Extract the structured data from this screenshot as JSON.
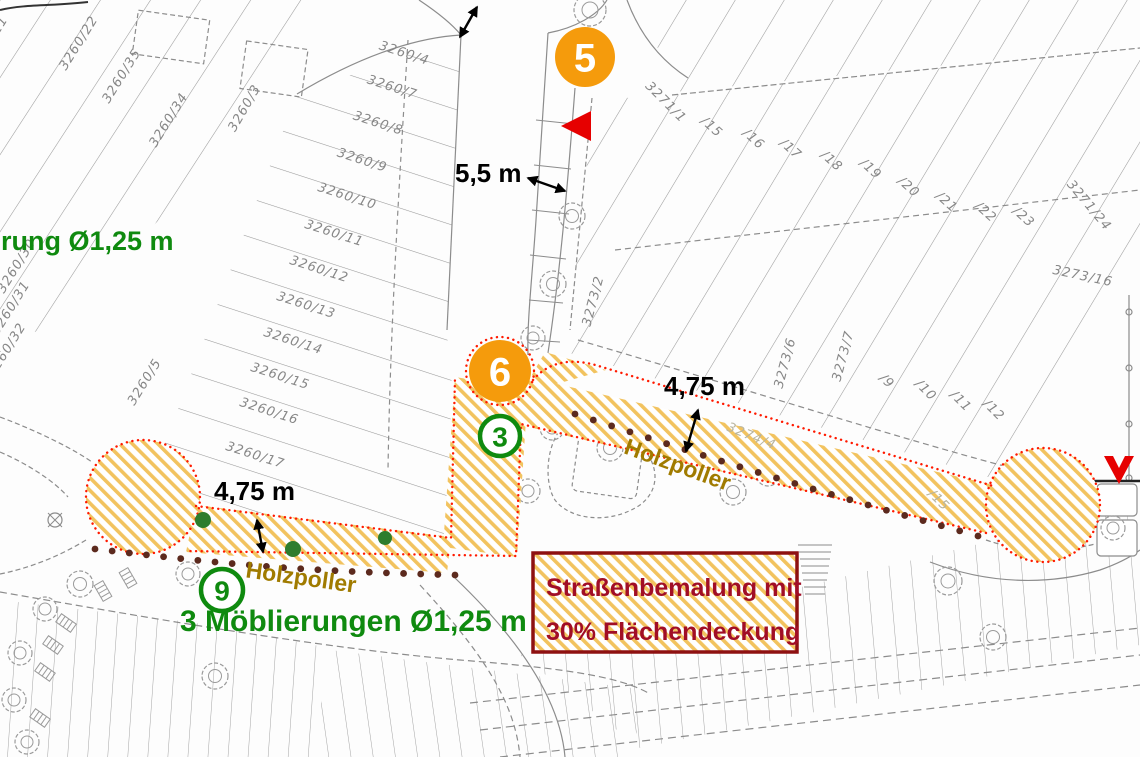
{
  "title": "Straßenbemalung Lageplan",
  "colors": {
    "paint_hatch": "#F2C35F",
    "paint_outline": "#FF1A00",
    "marker_orange": "#F59B0C",
    "marker_green": "#0F8A0F",
    "bollard_brown": "#5C2A1E",
    "furnishing_green": "#2E7D2E",
    "legend_border": "#8E1111",
    "legend_text": "#A10E26",
    "holzpoller_text": "#A07B00",
    "linework_gray": "#8C8C8C"
  },
  "legend": {
    "line1": "Straßenbemalung mit",
    "line2": "30% Flächendeckung"
  },
  "markers": {
    "orange": [
      {
        "label": "5",
        "x": 585,
        "y": 57
      },
      {
        "label": "6",
        "x": 500,
        "y": 371
      }
    ],
    "green": [
      {
        "label": "3",
        "x": 500,
        "y": 436
      },
      {
        "label": "9",
        "x": 222,
        "y": 590
      }
    ]
  },
  "measurements": [
    {
      "text": "5,5 m",
      "x": 455,
      "y": 182
    },
    {
      "text": "4,75 m",
      "x": 214,
      "y": 500
    },
    {
      "text": "4,75 m",
      "x": 664,
      "y": 395
    }
  ],
  "holzpoller_labels": [
    {
      "text": "Holzpoller",
      "x": 675,
      "y": 472,
      "rot": 20
    },
    {
      "text": "Holzpoller",
      "x": 300,
      "y": 585,
      "rot": 8
    }
  ],
  "green_notes": [
    {
      "text": "rung Ø1,25 m",
      "x": 1,
      "y": 250,
      "size": 27
    },
    {
      "text": "3 Möblierungen Ø1,25 m",
      "x": 180,
      "y": 631,
      "size": 30
    }
  ],
  "map": {
    "parcels": [
      {
        "text": "3260/4",
        "x": 403,
        "y": 57,
        "rot": 18
      },
      {
        "text": "3260/7",
        "x": 391,
        "y": 91,
        "rot": 18
      },
      {
        "text": "3260/8",
        "x": 377,
        "y": 127,
        "rot": 18
      },
      {
        "text": "3260/9",
        "x": 361,
        "y": 164,
        "rot": 18
      },
      {
        "text": "3260/10",
        "x": 346,
        "y": 200,
        "rot": 18
      },
      {
        "text": "3260/11",
        "x": 333,
        "y": 237,
        "rot": 18
      },
      {
        "text": "3260/12",
        "x": 318,
        "y": 273,
        "rot": 18
      },
      {
        "text": "3260/13",
        "x": 305,
        "y": 309,
        "rot": 18
      },
      {
        "text": "3260/14",
        "x": 292,
        "y": 345,
        "rot": 18
      },
      {
        "text": "3260/15",
        "x": 279,
        "y": 380,
        "rot": 18
      },
      {
        "text": "3260/16",
        "x": 268,
        "y": 415,
        "rot": 18
      },
      {
        "text": "3260/17",
        "x": 254,
        "y": 459,
        "rot": 18
      },
      {
        "text": "3260/21",
        "x": -8,
        "y": 45,
        "rot": -58
      },
      {
        "text": "3260/22",
        "x": 82,
        "y": 45,
        "rot": -58
      },
      {
        "text": "3260/35",
        "x": 125,
        "y": 78,
        "rot": -58
      },
      {
        "text": "3260/34",
        "x": 172,
        "y": 122,
        "rot": -58
      },
      {
        "text": "3260/3",
        "x": 248,
        "y": 110,
        "rot": -60
      },
      {
        "text": "3260/30",
        "x": 20,
        "y": 268,
        "rot": -58
      },
      {
        "text": "3260/31",
        "x": 14,
        "y": 310,
        "rot": -58
      },
      {
        "text": "3260/32",
        "x": 10,
        "y": 352,
        "rot": -58
      },
      {
        "text": "3260/5",
        "x": 148,
        "y": 384,
        "rot": -58
      },
      {
        "text": "3271/1",
        "x": 663,
        "y": 105,
        "rot": 45
      },
      {
        "text": "/15",
        "x": 709,
        "y": 130,
        "rot": 42
      },
      {
        "text": "/16",
        "x": 751,
        "y": 142,
        "rot": 42
      },
      {
        "text": "/17",
        "x": 788,
        "y": 152,
        "rot": 42
      },
      {
        "text": "/18",
        "x": 829,
        "y": 164,
        "rot": 42
      },
      {
        "text": "/19",
        "x": 868,
        "y": 172,
        "rot": 42
      },
      {
        "text": "/20",
        "x": 906,
        "y": 190,
        "rot": 42
      },
      {
        "text": "/21",
        "x": 944,
        "y": 205,
        "rot": 42
      },
      {
        "text": "/22",
        "x": 983,
        "y": 215,
        "rot": 42
      },
      {
        "text": "/23",
        "x": 1021,
        "y": 220,
        "rot": 42
      },
      {
        "text": "3271/24",
        "x": 1086,
        "y": 208,
        "rot": 50
      },
      {
        "text": "3273/16",
        "x": 1082,
        "y": 280,
        "rot": 12
      },
      {
        "text": "3273/2",
        "x": 597,
        "y": 302,
        "rot": -75
      },
      {
        "text": "3273/6",
        "x": 789,
        "y": 364,
        "rot": -75
      },
      {
        "text": "3273/7",
        "x": 847,
        "y": 357,
        "rot": -75
      },
      {
        "text": "/9",
        "x": 884,
        "y": 384,
        "rot": 45
      },
      {
        "text": "/10",
        "x": 923,
        "y": 393,
        "rot": 45
      },
      {
        "text": "/11",
        "x": 958,
        "y": 404,
        "rot": 45
      },
      {
        "text": "/12",
        "x": 991,
        "y": 413,
        "rot": 45
      },
      {
        "text": "3274/4",
        "x": 750,
        "y": 440,
        "rot": 22,
        "faint": true
      },
      {
        "text": "/15",
        "x": 936,
        "y": 503,
        "rot": 45,
        "faint": true
      }
    ],
    "holzpoller_chains": [
      {
        "x1": 95,
        "y1": 549,
        "x2": 455,
        "y2": 575,
        "count": 22,
        "bow": 5
      },
      {
        "x1": 575,
        "y1": 414,
        "x2": 978,
        "y2": 536,
        "count": 23,
        "bow": 3
      }
    ],
    "furnishings": [
      {
        "x": 203,
        "y": 520,
        "r": 8
      },
      {
        "x": 293,
        "y": 549,
        "r": 8
      },
      {
        "x": 385,
        "y": 538,
        "r": 7
      },
      {
        "x": 507,
        "y": 390,
        "r": 9
      }
    ],
    "trees": [
      {
        "x": 590,
        "y": 10,
        "r": 16
      },
      {
        "x": 572,
        "y": 216,
        "r": 13
      },
      {
        "x": 553,
        "y": 284,
        "r": 13
      },
      {
        "x": 533,
        "y": 338,
        "r": 12
      },
      {
        "x": 510,
        "y": 409,
        "r": 12
      },
      {
        "x": 552,
        "y": 428,
        "r": 12
      },
      {
        "x": 610,
        "y": 448,
        "r": 13
      },
      {
        "x": 528,
        "y": 491,
        "r": 12
      },
      {
        "x": 733,
        "y": 492,
        "r": 13
      },
      {
        "x": 768,
        "y": 474,
        "r": 12
      },
      {
        "x": 948,
        "y": 581,
        "r": 14
      },
      {
        "x": 993,
        "y": 637,
        "r": 13
      },
      {
        "x": 1113,
        "y": 528,
        "r": 12
      },
      {
        "x": 80,
        "y": 584,
        "r": 13
      },
      {
        "x": 45,
        "y": 609,
        "r": 12
      },
      {
        "x": 20,
        "y": 653,
        "r": 12
      },
      {
        "x": 188,
        "y": 574,
        "r": 12
      },
      {
        "x": 215,
        "y": 676,
        "r": 13
      },
      {
        "x": 14,
        "y": 700,
        "r": 12
      },
      {
        "x": 27,
        "y": 742,
        "r": 12
      }
    ],
    "benches": [
      {
        "x": 66,
        "y": 623,
        "rot": 35
      },
      {
        "x": 53,
        "y": 645,
        "rot": 35
      },
      {
        "x": 45,
        "y": 672,
        "rot": 35
      },
      {
        "x": 40,
        "y": 718,
        "rot": 35
      },
      {
        "x": 128,
        "y": 578,
        "rot": 60
      },
      {
        "x": 103,
        "y": 591,
        "rot": 60
      }
    ]
  }
}
